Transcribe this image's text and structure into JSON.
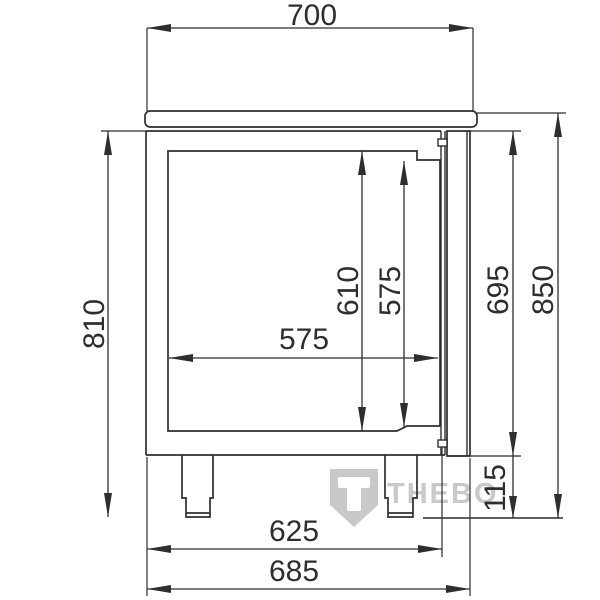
{
  "drawing_type": "refrigerated-counter-side-section",
  "dims": {
    "worktop_depth": "700",
    "body_height": "810",
    "interior_height_rear": "610",
    "interior_height_front": "575",
    "interior_depth": "575",
    "door_height": "695",
    "overall_height": "850",
    "plinth_height": "115",
    "body_depth": "625",
    "overall_depth": "685"
  },
  "watermark": {
    "shield_letter": "T",
    "brand_text": "THEBO"
  },
  "colors": {
    "line": "#2e2e2e",
    "watermark": "#c9c9c9",
    "background": "#ffffff"
  }
}
